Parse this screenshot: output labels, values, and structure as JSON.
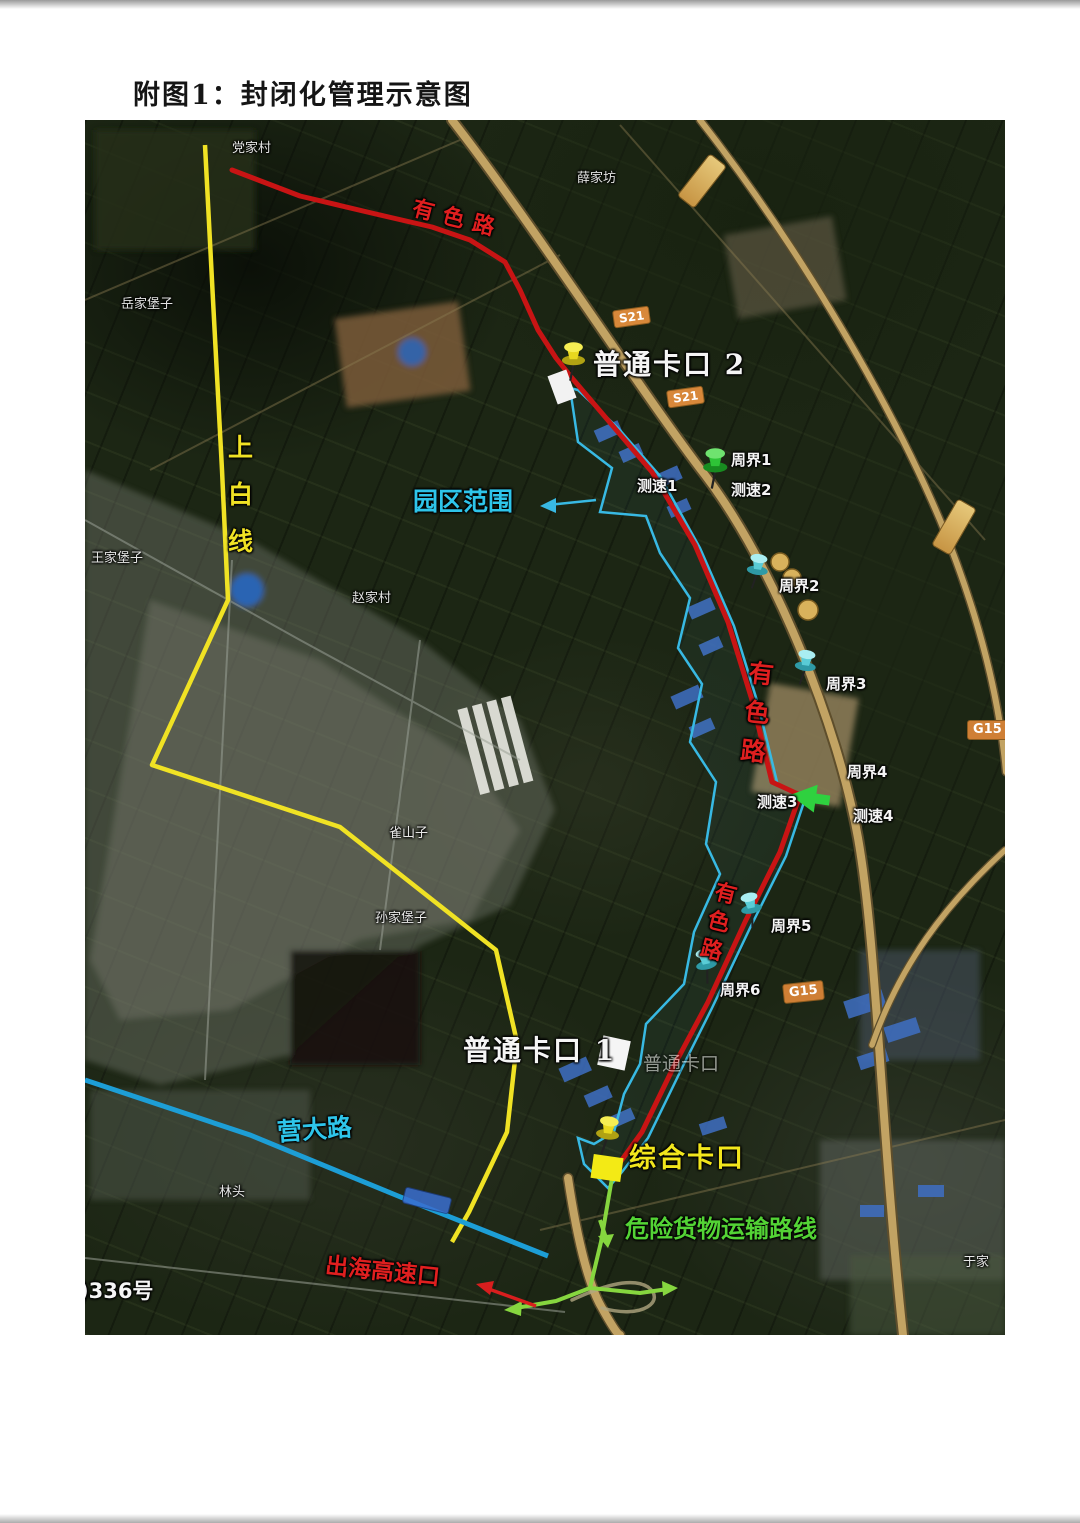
{
  "page": {
    "title": "附图1：封闭化管理示意图"
  },
  "map": {
    "road_labels": {
      "youse_top": "有色路",
      "youse_mid": "有色路",
      "youse_lower": "有色路",
      "shangbai": "上白线",
      "yingda": "营大路"
    },
    "checkpoints": {
      "putong2": "普通卡口 2",
      "putong1": "普通卡口 1",
      "putong1_small": "普通卡口",
      "zonghe": "综合卡口"
    },
    "annotations": {
      "park_range": "园区范围",
      "dangerous_route": "危险货物运输路线",
      "sea_exit": "出海高速口",
      "ref_number": ")336号"
    },
    "perimeters": [
      {
        "label": "周界1"
      },
      {
        "label": "周界2"
      },
      {
        "label": "周界3"
      },
      {
        "label": "周界4"
      },
      {
        "label": "周界5"
      },
      {
        "label": "周界6"
      }
    ],
    "speed_points": [
      {
        "label": "测速1"
      },
      {
        "label": "测速2"
      },
      {
        "label": "测速3"
      },
      {
        "label": "测速4"
      }
    ],
    "villages": [
      {
        "name": "党家村"
      },
      {
        "name": "薛家坊"
      },
      {
        "name": "岳家堡子"
      },
      {
        "name": "王家堡子"
      },
      {
        "name": "赵家村"
      },
      {
        "name": "雀山子"
      },
      {
        "name": "孙家堡子"
      },
      {
        "name": "林头"
      },
      {
        "name": "于家"
      }
    ],
    "badges": [
      {
        "label": "S21"
      },
      {
        "label": "S21"
      },
      {
        "label": "G15"
      },
      {
        "label": "G15"
      }
    ],
    "colors": {
      "route_red": "#c81414",
      "boundary_cyan": "#38b9e3",
      "line_yellow": "#f0e224",
      "road_blue": "#1d9ed6",
      "route_green": "#86d63f",
      "label_green": "#53d335",
      "label_cyan": "#2ec5ea",
      "label_yellow": "#f2e61c",
      "label_red": "#e01f1f",
      "highway_tan": "#c2a363"
    }
  }
}
